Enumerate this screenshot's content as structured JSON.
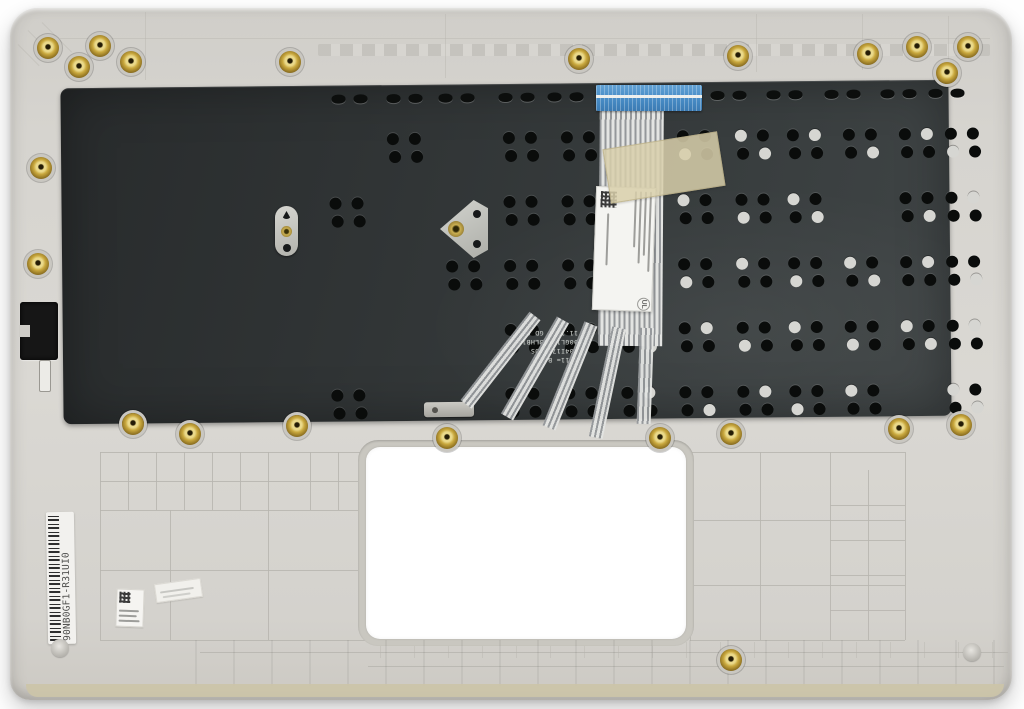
{
  "part": {
    "side_label": "90NB0GF1-R31UI0",
    "plate_print_lines": [
      "A 11= B",
      "A04I1703 US",
      "00GL17A73LHB11",
      "11.12Q1 GD 6"
    ],
    "ribbon_label_cert": "UL"
  },
  "colors": {
    "background": "#ffffff",
    "case_plastic": "#d7d5d0",
    "keyboard_plate": "#34383a",
    "ribbon_connector_blue": "#4a8fc9",
    "kapton_tape": "#d6cda6",
    "screw_gold": "#c9a83e",
    "label_white": "#f4f3f0"
  }
}
